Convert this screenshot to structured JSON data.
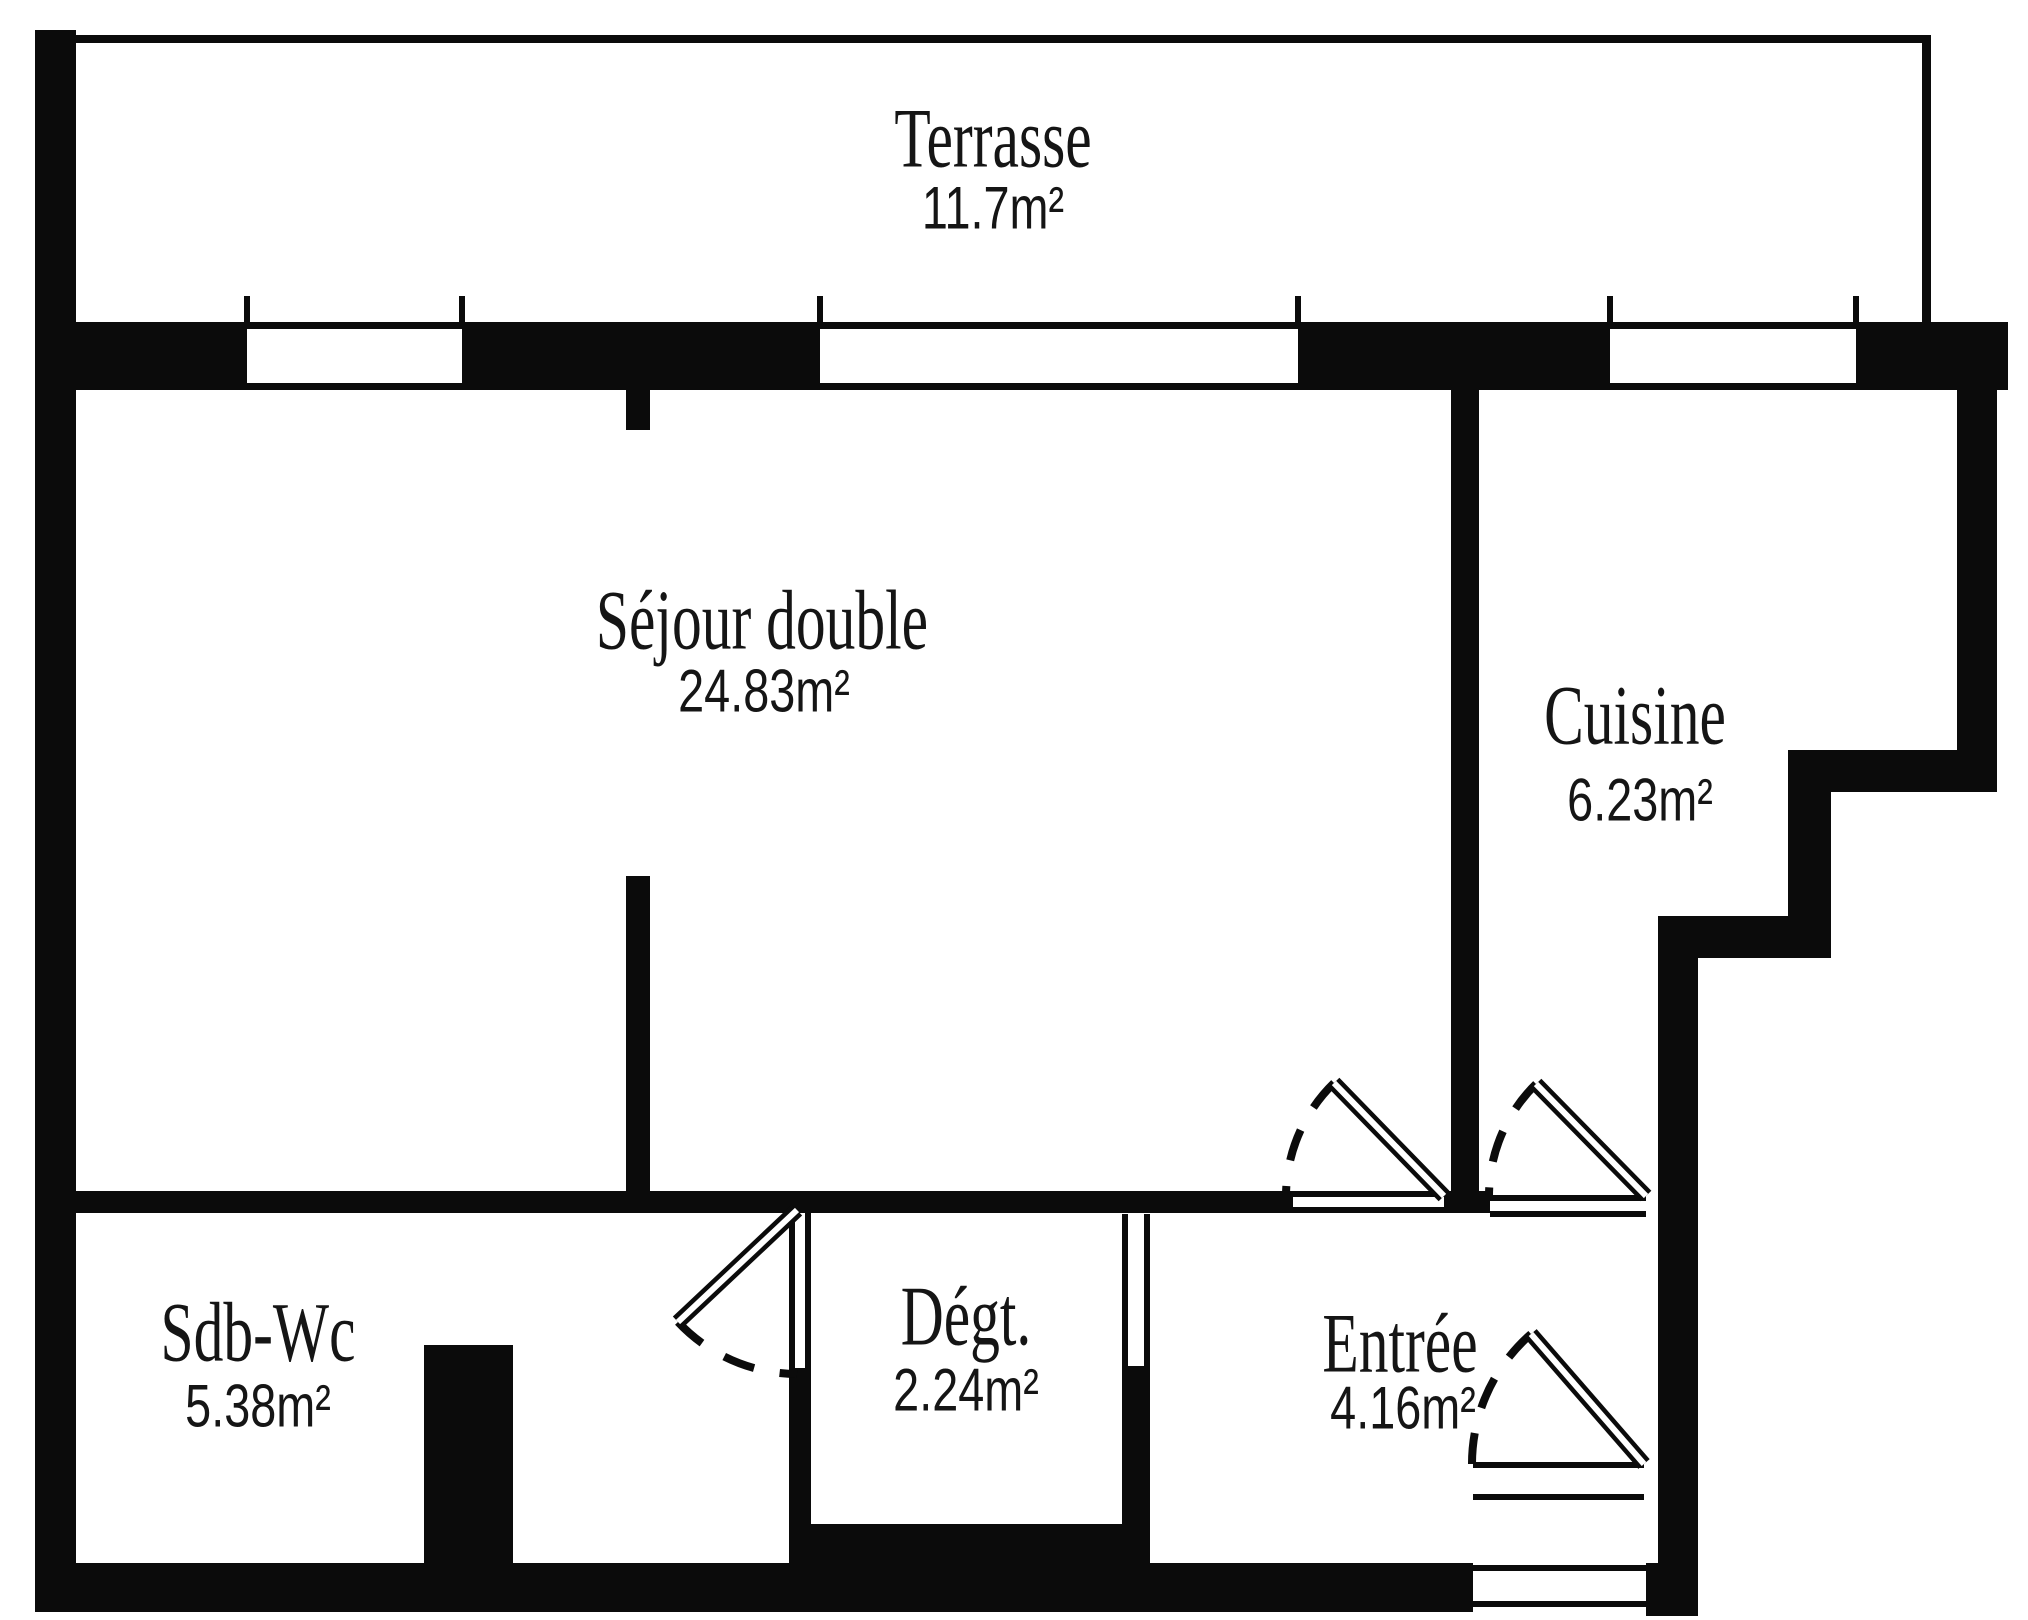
{
  "plan": {
    "type": "apartment-floor-plan",
    "colors": {
      "wall": "#0b0b0b",
      "background": "#ffffff"
    },
    "rooms": [
      {
        "name": "Terrasse",
        "area": "11.7m²"
      },
      {
        "name": "Séjour double",
        "area": "24.83m²"
      },
      {
        "name": "Cuisine",
        "area": "6.23m²"
      },
      {
        "name": "Sdb-Wc",
        "area": "5.38m²"
      },
      {
        "name": "Dégt.",
        "area": "2.24m²"
      },
      {
        "name": "Entrée",
        "area": "4.16m²"
      }
    ]
  }
}
